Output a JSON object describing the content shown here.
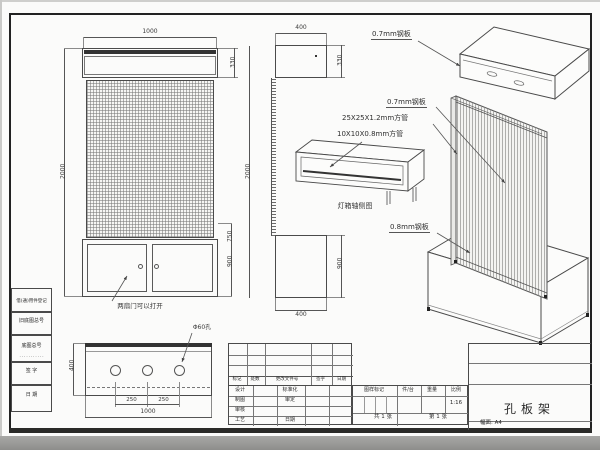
{
  "front": {
    "w": "1000",
    "lb": "330",
    "h_l": "2000",
    "h_r": "2000",
    "d1": "750",
    "d2": "900",
    "note": "两扇门可以打开"
  },
  "plan": {
    "depth": "400",
    "s1": "250",
    "s2": "250",
    "w": "1000",
    "hole": "Φ60孔"
  },
  "side": {
    "t": "400",
    "lb": "330",
    "b": "400",
    "cab": "900"
  },
  "detail": {
    "cap": "灯箱轴侧图"
  },
  "ann": {
    "a1": "0.7mm钢板",
    "a2": "0.7mm钢板",
    "a3": "25X25X1.2mm方管",
    "a4": "10X10X0.8mm方管",
    "a5": "0.8mm钢板"
  },
  "tb": {
    "h1": "标记",
    "h2": "处数",
    "h3": "更改文件号",
    "h4": "签字",
    "h5": "日期",
    "r1": "设计",
    "r2": "制图",
    "r3": "审核",
    "r4": "工艺",
    "m1": "标准化",
    "m2": "审定",
    "m3": "日期",
    "s1": "图样标记",
    "s2": "件/台",
    "s3": "重量",
    "s4": "比例",
    "scale": "1:16",
    "sheets": "共 1 张",
    "sheet": "第 1 张",
    "name": "孔板架",
    "fmt": "幅面: A4"
  },
  "margin": {
    "f1": "借(通)用件登记",
    "f2": "旧底图总号",
    "f3": "底图总号",
    "f3s": "···········",
    "f4": "签 字",
    "f5": "日 期"
  }
}
